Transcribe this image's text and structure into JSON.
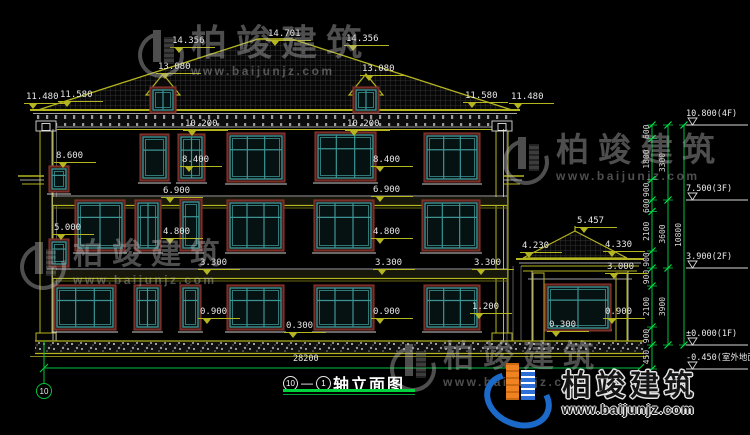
{
  "colors": {
    "background": "#000000",
    "line_yellow": "#b5b520",
    "line_white": "#e8e8e8",
    "window_teal": "#3d9494",
    "window_maroon": "#7a3028",
    "axis_green": "#00c43c",
    "watermark_gray": "#b9b9b9",
    "logo_blue": "#1b6ac9",
    "logo_orange": "#f08221"
  },
  "watermark": {
    "text": "柏竣建筑",
    "url": "www.baijunjz.com",
    "positions": [
      {
        "x": 138,
        "y": 24,
        "size": 36
      },
      {
        "x": 503,
        "y": 131,
        "size": 33
      },
      {
        "x": 20,
        "y": 236,
        "size": 30
      },
      {
        "x": 390,
        "y": 338,
        "size": 31
      }
    ]
  },
  "brand": {
    "text": "柏竣建筑",
    "url": "www.baijunjz.com"
  },
  "title_block": {
    "axis_a": "10",
    "axis_b": "1",
    "name": "轴立面图"
  },
  "overall_dim": "28200",
  "axis_bubble": "10",
  "dim_labels": [
    {
      "text": "14.356",
      "x": 170,
      "y": 36
    },
    {
      "text": "14.701",
      "x": 266,
      "y": 29
    },
    {
      "text": "14.356",
      "x": 344,
      "y": 34
    },
    {
      "text": "13.080",
      "x": 156,
      "y": 62
    },
    {
      "text": "13.080",
      "x": 360,
      "y": 64
    },
    {
      "text": "11.480",
      "x": 24,
      "y": 92
    },
    {
      "text": "11.580",
      "x": 58,
      "y": 90
    },
    {
      "text": "11.580",
      "x": 463,
      "y": 91
    },
    {
      "text": "11.480",
      "x": 509,
      "y": 92
    },
    {
      "text": "10.200",
      "x": 183,
      "y": 119
    },
    {
      "text": "10.200",
      "x": 345,
      "y": 119
    },
    {
      "text": "8.600",
      "x": 54,
      "y": 151
    },
    {
      "text": "8.400",
      "x": 180,
      "y": 155
    },
    {
      "text": "8.400",
      "x": 371,
      "y": 155
    },
    {
      "text": "6.900",
      "x": 161,
      "y": 186
    },
    {
      "text": "6.900",
      "x": 371,
      "y": 185
    },
    {
      "text": "5.000",
      "x": 52,
      "y": 223
    },
    {
      "text": "4.800",
      "x": 161,
      "y": 227
    },
    {
      "text": "4.800",
      "x": 371,
      "y": 227
    },
    {
      "text": "3.300",
      "x": 198,
      "y": 258
    },
    {
      "text": "3.300",
      "x": 373,
      "y": 258
    },
    {
      "text": "3.300",
      "x": 472,
      "y": 258
    },
    {
      "text": "1.200",
      "x": 470,
      "y": 302
    },
    {
      "text": "0.900",
      "x": 198,
      "y": 307
    },
    {
      "text": "0.900",
      "x": 371,
      "y": 307
    },
    {
      "text": "0.300",
      "x": 284,
      "y": 321
    },
    {
      "text": "5.457",
      "x": 575,
      "y": 216
    },
    {
      "text": "4.230",
      "x": 520,
      "y": 241
    },
    {
      "text": "4.330",
      "x": 603,
      "y": 240
    },
    {
      "text": "3.000",
      "x": 605,
      "y": 262
    },
    {
      "text": "0.900",
      "x": 603,
      "y": 307
    },
    {
      "text": "0.300",
      "x": 547,
      "y": 320
    }
  ],
  "level_flags": [
    {
      "text": "10.800(4F)",
      "y": 125
    },
    {
      "text": "7.500(3F)",
      "y": 200
    },
    {
      "text": "3.900(2F)",
      "y": 268
    },
    {
      "text": "±0.000(1F)",
      "y": 345
    },
    {
      "text": "-0.450(室外地面)",
      "y": 369
    }
  ],
  "chain": {
    "col1": {
      "values": [
        "600",
        "1800",
        "900",
        "600",
        "2100",
        "900",
        "900",
        "2100",
        "900",
        "450"
      ],
      "boundaries": [
        125,
        138.5,
        179.5,
        200,
        211.5,
        251,
        268,
        286,
        327,
        345,
        369
      ]
    },
    "col2": {
      "values": [
        "3300",
        "3600",
        "3900"
      ],
      "boundaries": [
        125,
        200,
        268,
        345
      ]
    },
    "col3": {
      "values": [
        "10800"
      ],
      "boundaries": [
        125,
        345
      ]
    }
  }
}
